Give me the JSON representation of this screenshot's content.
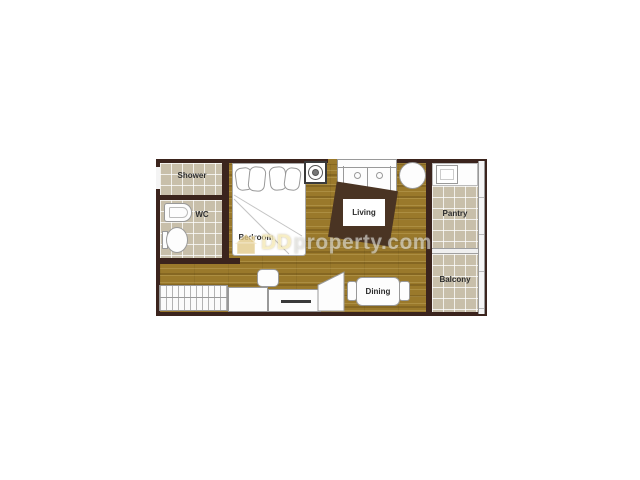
{
  "rooms": {
    "shower": {
      "label": "Shower"
    },
    "wc": {
      "label": "WC"
    },
    "bedroom": {
      "label": "Bedroom"
    },
    "living": {
      "label": "Living"
    },
    "pantry": {
      "label": "Pantry"
    },
    "balcony": {
      "label": "Balcony"
    },
    "dining": {
      "label": "Dining"
    }
  },
  "watermark": {
    "dd": "DD",
    "rest": "property.com",
    "full": "DDproperty.com",
    "icon": "house-icon"
  },
  "colors": {
    "background": "#ffffff",
    "wall": "#3b241d",
    "wood_floor": "#9a792b",
    "tile_floor": "#c8bfaa",
    "rug": "#4a3423"
  },
  "furniture_icons": [
    "bed",
    "sofa",
    "round-table",
    "washing-machine-icon",
    "rug",
    "dining-table",
    "dining-chair",
    "wardrobe",
    "desk",
    "stool",
    "tv-console",
    "wc-sink",
    "toilet",
    "pantry-counter",
    "pantry-sink",
    "balcony-railing"
  ]
}
